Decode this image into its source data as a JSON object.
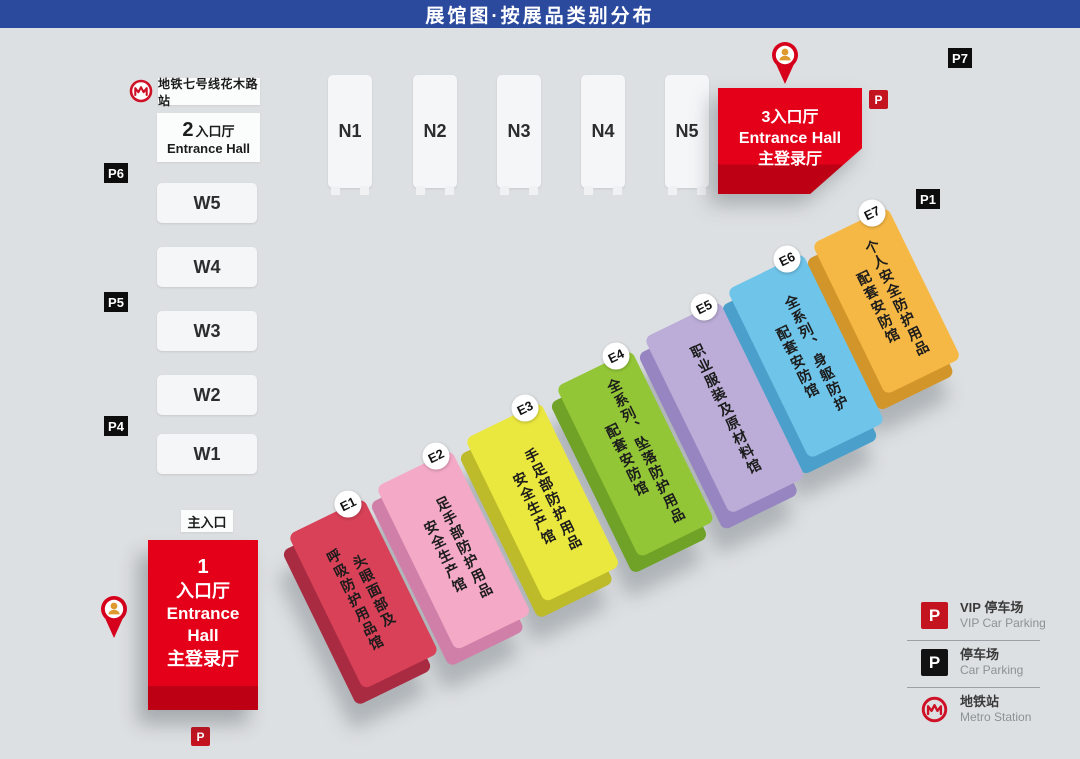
{
  "banner": {
    "title": "展馆图·按展品类别分布"
  },
  "colors": {
    "banner_blue": "#2B4A9E",
    "background": "#DDE0E2",
    "entrance_red": "#E50019",
    "entrance_red_dark": "#BE0014",
    "parking_red": "#C41420",
    "parking_black": "#0D0D0D",
    "metro_red": "#CE1126",
    "pin_red": "#D6001C"
  },
  "metro_line": {
    "label": "地铁七号线花木路站"
  },
  "entrance2": {
    "number": "2",
    "zh": "入口厅",
    "en": "Entrance Hall"
  },
  "entrance3": {
    "line1": "3入口厅",
    "line2": "Entrance Hall",
    "line3": "主登录厅"
  },
  "entrance1": {
    "line1": "1",
    "line2": "入口厅",
    "line3": "Entrance",
    "line4": "Hall",
    "line5": "主登录厅"
  },
  "main_entrance": "主入口",
  "north_halls": [
    "N1",
    "N2",
    "N3",
    "N4",
    "N5"
  ],
  "west_halls": [
    "W5",
    "W4",
    "W3",
    "W2",
    "W1"
  ],
  "east_halls": [
    {
      "id": "E1",
      "lines": [
        "头眼面部及",
        "呼吸防护用品馆"
      ],
      "face": "#D84157",
      "side": "#A92B42"
    },
    {
      "id": "E2",
      "lines": [
        "足手部防护用品",
        "安全生产馆"
      ],
      "face": "#F4A9C6",
      "side": "#D07FA8"
    },
    {
      "id": "E3",
      "lines": [
        "手足部防护用品",
        "安全生产馆"
      ],
      "face": "#EAE73F",
      "side": "#BDBB29"
    },
    {
      "id": "E4",
      "lines": [
        "全系列、坠落防护用品",
        "配套安防馆"
      ],
      "face": "#93C637",
      "side": "#6FA226"
    },
    {
      "id": "E5",
      "lines": [
        "职业服装及原材料馆"
      ],
      "face": "#BBADD8",
      "side": "#9685C1"
    },
    {
      "id": "E6",
      "lines": [
        "全系列、身躯防护",
        "配套安防馆"
      ],
      "face": "#6FC4E9",
      "side": "#4BA0CB"
    },
    {
      "id": "E7",
      "lines": [
        "个人安全防护用品",
        "配套安防馆"
      ],
      "face": "#F6B845",
      "side": "#D2952A"
    }
  ],
  "parking_black_labels": [
    "P7",
    "P6",
    "P5",
    "P4",
    "P1"
  ],
  "parking_red_label": "P",
  "legend": [
    {
      "icon": "vip-parking-icon",
      "zh": "VIP 停车场",
      "en": "VIP Car Parking",
      "color": "#C41420"
    },
    {
      "icon": "parking-icon",
      "zh": "停车场",
      "en": "Car Parking",
      "color": "#121212"
    },
    {
      "icon": "metro-icon",
      "zh": "地铁站",
      "en": "Metro Station",
      "color": "#CE1126"
    }
  ]
}
